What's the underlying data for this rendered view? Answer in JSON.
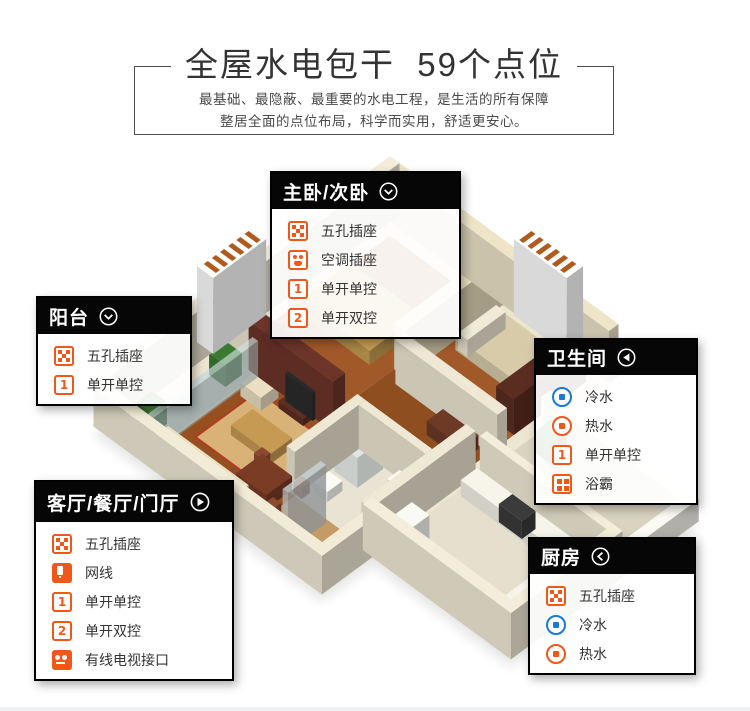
{
  "header": {
    "title": "全屋水电包干  59个点位",
    "subtitle_line1": "最基础、最隐蔽、最重要的水电工程，是生活的所有保障",
    "subtitle_line2": "整居全面的点位布局，科学而实用，舒适更安心。"
  },
  "glyphs": {
    "switch1": "1",
    "switch2": "2"
  },
  "colors": {
    "accent_orange": "#f2571a",
    "cold_water_blue": "#1879dd",
    "callout_header_black": "#060606"
  },
  "callouts": [
    {
      "id": "master-second-bedroom",
      "title": "主卧/次卧",
      "arrow": "chevron-down-circle",
      "items": [
        {
          "icon": "five-hole-socket",
          "label": "五孔插座"
        },
        {
          "icon": "ac-socket",
          "label": "空调插座"
        },
        {
          "icon": "switch-single-1",
          "label": "单开单控"
        },
        {
          "icon": "switch-single-2",
          "label": "单开双控"
        }
      ]
    },
    {
      "id": "balcony",
      "title": "阳台",
      "arrow": "chevron-down-circle",
      "items": [
        {
          "icon": "five-hole-socket",
          "label": "五孔插座"
        },
        {
          "icon": "switch-single-1",
          "label": "单开单控"
        }
      ]
    },
    {
      "id": "bathroom",
      "title": "卫生间",
      "arrow": "arrow-left-circle",
      "items": [
        {
          "icon": "cold-water",
          "label": "冷水"
        },
        {
          "icon": "hot-water",
          "label": "热水"
        },
        {
          "icon": "switch-single-1",
          "label": "单开单控"
        },
        {
          "icon": "bath-heater",
          "label": "浴霸"
        }
      ]
    },
    {
      "id": "living-dining-entry",
      "title": "客厅/餐厅/门厅",
      "arrow": "arrow-right-circle",
      "items": [
        {
          "icon": "five-hole-socket",
          "label": "五孔插座"
        },
        {
          "icon": "network-port",
          "label": "网线"
        },
        {
          "icon": "switch-single-1",
          "label": "单开单控"
        },
        {
          "icon": "switch-single-2",
          "label": "单开双控"
        },
        {
          "icon": "tv-port",
          "label": "有线电视接口"
        }
      ]
    },
    {
      "id": "kitchen",
      "title": "厨房",
      "arrow": "chevron-left-circle",
      "items": [
        {
          "icon": "five-hole-socket",
          "label": "五孔插座"
        },
        {
          "icon": "cold-water",
          "label": "冷水"
        },
        {
          "icon": "hot-water",
          "label": "热水"
        }
      ]
    }
  ]
}
